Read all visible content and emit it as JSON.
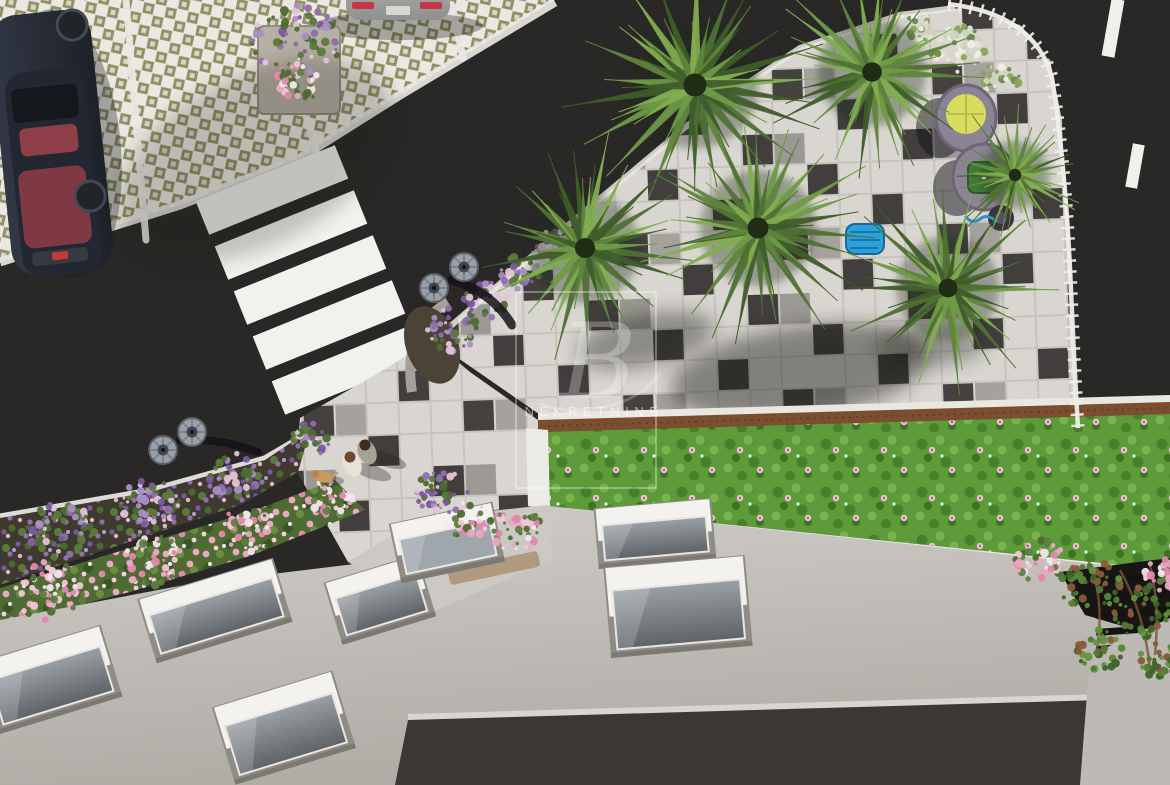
{
  "scene": {
    "kind": "aerial-architectural-render",
    "watermark": {
      "monogram": "B",
      "label": "NEKRETNINE"
    },
    "palette": {
      "asphalt": "#232120",
      "pavementLight": "#d9d6d1",
      "pavementDark": "#413e3d",
      "paverBg": "#eae8e0",
      "paverOlive": "#8d8d62",
      "lawnGreen": "#5c9a3a",
      "wood": "#7a4e2e",
      "buildingGray": "#c2bfba",
      "parapetDark": "#3a3734",
      "windowFrame": "#f3f2ee",
      "windowGlass": "#6b7075",
      "curbWhite": "#eceae4",
      "carNavy": "#272c38",
      "carSilver": "#a9a9a7",
      "flowerPurple": "#8f6fae",
      "flowerPink": "#eaa8c2",
      "chairBody": "#8c8494",
      "chairYellow": "#d8dd5f",
      "chairGreen": "#3f7b37",
      "poolBlue": "#2ba0da",
      "lampCap": "#99a0a8",
      "palmGreens": [
        "#3f5c2a",
        "#4f7134",
        "#5f853d",
        "#6f9a47",
        "#82ad52"
      ]
    },
    "palms": [
      {
        "cx": 695,
        "cy": 85,
        "r": 115,
        "seed": 1
      },
      {
        "cx": 585,
        "cy": 248,
        "r": 100,
        "seed": 2
      },
      {
        "cx": 758,
        "cy": 228,
        "r": 105,
        "seed": 3
      },
      {
        "cx": 872,
        "cy": 72,
        "r": 98,
        "seed": 4
      },
      {
        "cx": 948,
        "cy": 288,
        "r": 94,
        "seed": 5
      },
      {
        "cx": 1015,
        "cy": 175,
        "r": 62,
        "seed": 6
      }
    ],
    "palmShadows": [
      {
        "cx": 800,
        "cy": 372,
        "rx": 130,
        "ry": 46,
        "rot": -8,
        "o": 0.45
      },
      {
        "cx": 645,
        "cy": 340,
        "rx": 70,
        "ry": 26,
        "rot": -12,
        "o": 0.4
      },
      {
        "cx": 930,
        "cy": 345,
        "rx": 55,
        "ry": 20,
        "rot": 0,
        "o": 0.35
      },
      {
        "cx": 255,
        "cy": 160,
        "rx": 150,
        "ry": 85,
        "rot": -28,
        "o": 0.22
      }
    ],
    "crosswalk": {
      "x": 272,
      "y": 190,
      "dx": 19,
      "dy": 45,
      "count": 5,
      "w": 150,
      "h": 36,
      "rot": -22
    },
    "laneDashes": [
      {
        "cx": 1113,
        "cy": 28,
        "w": 13,
        "h": 58,
        "rot": 10
      },
      {
        "cx": 1135,
        "cy": 166,
        "w": 12,
        "h": 44,
        "rot": 10
      }
    ],
    "parkingLines": [
      {
        "x1": 126,
        "y1": 0,
        "x2": 146,
        "y2": 240
      },
      {
        "x1": 305,
        "y1": 112,
        "x2": 318,
        "y2": 158
      },
      {
        "x1": 452,
        "y1": 5,
        "x2": 463,
        "y2": 58
      }
    ],
    "lamps": [
      {
        "cx": 434,
        "cy": 288
      },
      {
        "cx": 464,
        "cy": 267
      },
      {
        "cx": 163,
        "cy": 450
      },
      {
        "cx": 192,
        "cy": 432
      }
    ],
    "windows": [
      {
        "cx": 215,
        "cy": 611,
        "w": 128,
        "h": 50,
        "rot": -17
      },
      {
        "cx": 50,
        "cy": 680,
        "w": 115,
        "h": 58,
        "rot": -17
      },
      {
        "cx": 284,
        "cy": 728,
        "w": 112,
        "h": 64,
        "rot": -17
      },
      {
        "cx": 380,
        "cy": 600,
        "w": 84,
        "h": 48,
        "rot": -17
      },
      {
        "cx": 655,
        "cy": 534,
        "w": 104,
        "h": 44,
        "rot": -5
      },
      {
        "cx": 678,
        "cy": 607,
        "w": 128,
        "h": 74,
        "rot": -5
      }
    ],
    "skylight": {
      "cx": 447,
      "cy": 543,
      "w": 92,
      "h": 44,
      "rot": -12
    },
    "ventSlats": {
      "x": 1096,
      "y": 578,
      "step": 17,
      "w": 70,
      "h": 7,
      "n": 5,
      "rot": -4
    },
    "pedestrians": [
      {
        "kind": "person",
        "x": 352,
        "y": 464,
        "shirt": "#e9e3d6",
        "hair": "#6b4a2e"
      },
      {
        "kind": "person",
        "x": 367,
        "y": 452,
        "shirt": "#a8a296",
        "hair": "#3c2c1e"
      },
      {
        "kind": "dog",
        "x": 323,
        "y": 477,
        "coat": "#c99a5c"
      }
    ],
    "flowerPalettes": {
      "purple": [
        "#8f6fae",
        "#7a58a0",
        "#a98fc5",
        "#5a7a3a",
        "#4e6b33",
        "#e2c4d6"
      ],
      "rose": [
        "#eaa8c2",
        "#f2c6d8",
        "#e089ab",
        "#4e6b33",
        "#5d8040",
        "#f6e6ee"
      ],
      "white": [
        "#f0eee8",
        "#e6e2d6",
        "#cfd4c0",
        "#6b8a4a",
        "#8aa45e"
      ],
      "ivy": [
        "#4e7a33",
        "#3e6328",
        "#629540",
        "#8a5a3a",
        "#56863a"
      ],
      "green": [
        "#5a8a3a",
        "#4a7a30",
        "#6f9a47"
      ]
    },
    "flowerClusters": [
      {
        "cx": 296,
        "cy": 42,
        "r": 44,
        "type": "purple"
      },
      {
        "cx": 300,
        "cy": 78,
        "r": 26,
        "type": "rose"
      },
      {
        "cx": 452,
        "cy": 330,
        "r": 26,
        "type": "purple"
      },
      {
        "cx": 485,
        "cy": 300,
        "r": 22,
        "type": "purple"
      },
      {
        "cx": 520,
        "cy": 272,
        "r": 20,
        "type": "purple"
      },
      {
        "cx": 552,
        "cy": 246,
        "r": 18,
        "type": "purple"
      },
      {
        "cx": 958,
        "cy": 48,
        "r": 28,
        "type": "white"
      },
      {
        "cx": 1000,
        "cy": 80,
        "r": 20,
        "type": "white"
      },
      {
        "cx": 915,
        "cy": 30,
        "r": 18,
        "type": "white"
      },
      {
        "cx": 60,
        "cy": 532,
        "r": 34,
        "type": "purple"
      },
      {
        "cx": 150,
        "cy": 505,
        "r": 30,
        "type": "purple"
      },
      {
        "cx": 235,
        "cy": 475,
        "r": 26,
        "type": "purple"
      },
      {
        "cx": 310,
        "cy": 440,
        "r": 20,
        "type": "purple"
      },
      {
        "cx": 50,
        "cy": 590,
        "r": 36,
        "type": "rose"
      },
      {
        "cx": 150,
        "cy": 560,
        "r": 32,
        "type": "rose"
      },
      {
        "cx": 250,
        "cy": 528,
        "r": 28,
        "type": "rose"
      },
      {
        "cx": 330,
        "cy": 498,
        "r": 22,
        "type": "rose"
      },
      {
        "cx": 442,
        "cy": 492,
        "r": 26,
        "type": "purple"
      },
      {
        "cx": 468,
        "cy": 520,
        "r": 22,
        "type": "rose"
      },
      {
        "cx": 515,
        "cy": 530,
        "r": 28,
        "type": "rose"
      },
      {
        "cx": 1040,
        "cy": 562,
        "r": 26,
        "type": "rose"
      },
      {
        "cx": 1090,
        "cy": 585,
        "r": 30,
        "type": "ivy"
      },
      {
        "cx": 1140,
        "cy": 612,
        "r": 30,
        "type": "ivy"
      },
      {
        "cx": 1165,
        "cy": 575,
        "r": 20,
        "type": "rose"
      },
      {
        "cx": 1100,
        "cy": 650,
        "r": 24,
        "type": "ivy"
      },
      {
        "cx": 1158,
        "cy": 660,
        "r": 20,
        "type": "ivy"
      }
    ]
  }
}
